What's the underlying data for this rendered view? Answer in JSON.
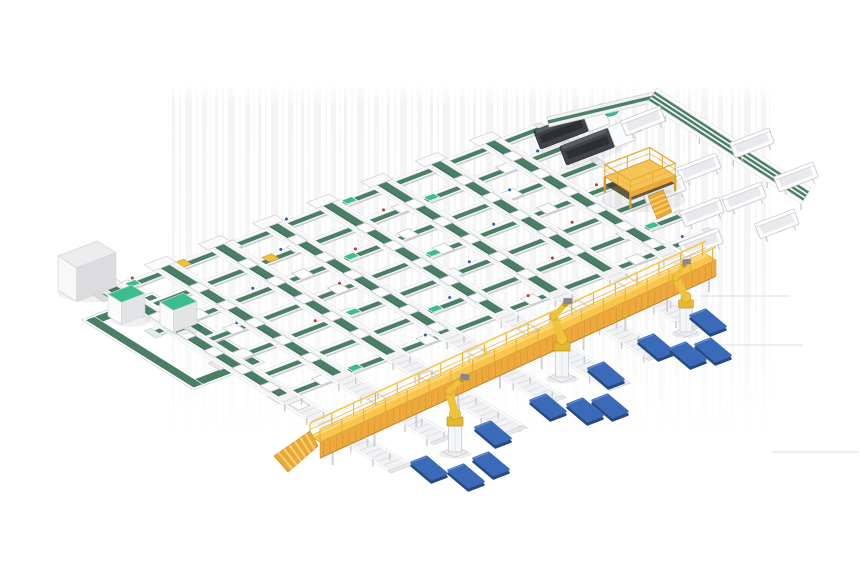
{
  "meta": {
    "description": "3D isometric render of an automated parcel sorting facility: grid of green belt conveyors, yellow elevated picking walkway with robot arms, blue pallets, chute bins, mezzanine platform and line-end machines on a white background",
    "canvas": {
      "width": 860,
      "height": 580
    }
  },
  "palette": {
    "background": "#ffffff",
    "artifact": "#dcdcdc",
    "frame": "#f1f2f4",
    "frame2": "#e8e9ec",
    "frame_stroke": "#d3d5d9",
    "frame_dark": "#c9ccd1",
    "belt": "#4a7e65",
    "belt_dark": "#3c6a54",
    "teal": "#3cbd8e",
    "teal_stroke": "#2a8f69",
    "walkway_top": "#f8c64e",
    "walkway_light": "#ffd86e",
    "walkway_side": "#eda93e",
    "walkway_shade": "#d6952f",
    "walkway_stroke": "#d9a133",
    "stair": "#e9a83c",
    "stair_step": "#ffd267",
    "stair_stroke": "#cf8f2b",
    "robot_yellow": "#eec33c",
    "robot_shade": "#c79d27",
    "robot_base": "#e5b92f",
    "gripper": "#85888c",
    "pallet_top": "#3a6ab8",
    "pallet_edge": "#274a80",
    "pallet_hi": "#6f97d2",
    "machine": "#3f4449",
    "machine_dark": "#2c3033",
    "machine_hi": "#585f64",
    "item_stroke": "#c8cbd0",
    "dot_red": "#c0392b",
    "dot_blue": "#2b5fb0",
    "leg": "#cdd0d4",
    "platform_deck": "#f5c455",
    "platform_under": "#4a3f28",
    "platform_rail": "#e8ae3c",
    "platform_stroke": "#d89c2f",
    "cabinet_top": "#ededef",
    "cabinet_left": "#f8f8f9",
    "cabinet_right": "#dcdcdf",
    "box_left": "#fbfbfc",
    "box_right": "#e3e4e6"
  },
  "scene": {
    "background": {
      "streak_band": {
        "x": 168,
        "y": 84,
        "w": 605,
        "h": 356
      },
      "faint_lines": [
        [
          700,
          296,
          790,
          296
        ],
        [
          718,
          345,
          803,
          345
        ],
        [
          772,
          452,
          858,
          452
        ]
      ]
    },
    "lattice": {
      "origin": [
        98,
        298
      ],
      "u": [
        0.934,
        -0.358
      ],
      "v": [
        0.848,
        0.53
      ],
      "rows": {
        "count": 7,
        "spacing": 33,
        "length": 480,
        "starts": [
          0,
          10,
          -4,
          14,
          4,
          18,
          8
        ]
      },
      "lanes": {
        "xs": [
          20,
          78,
          136,
          194,
          252,
          310,
          368,
          426
        ],
        "top": -18,
        "belt_end": 196,
        "ends": [
          332,
          318,
          340,
          322,
          334,
          316,
          300,
          245
        ]
      },
      "yellow_items": [
        [
          88,
          -7
        ],
        [
          152,
          26
        ]
      ],
      "loop": {
        "outer": [
          -34,
          18,
          42,
          150
        ],
        "strips": [
          [
            -32,
            20,
            40,
            30
          ],
          [
            -32,
            138,
            40,
            148
          ],
          [
            -32,
            20,
            -22,
            148
          ],
          [
            30,
            20,
            40,
            148
          ]
        ]
      }
    },
    "cabinet": {
      "x": 58,
      "y": 290,
      "du": 42,
      "dv": 22,
      "h": 34
    },
    "tote_boxes": [
      {
        "x": 108,
        "y": 316,
        "du": 25,
        "dv": 16,
        "h": 22
      },
      {
        "x": 160,
        "y": 324,
        "du": 25,
        "dv": 16,
        "h": 22
      }
    ],
    "machines": [
      [
        537,
        140
      ],
      [
        563,
        156
      ]
    ],
    "platform": {
      "cx": 640,
      "cy": 192,
      "half_u": 24,
      "half_v": 15,
      "deck_h": 16,
      "rail_h": 12,
      "stairs": [
        [
          648,
          196
        ],
        [
          663,
          190
        ],
        [
          672,
          212
        ],
        [
          657,
          219
        ]
      ]
    },
    "wing": {
      "connector": {
        "from": [
          548,
          122
        ],
        "to": [
          654,
          97
        ]
      },
      "multilane": {
        "from": [
          652,
          96
        ],
        "to": [
          806,
          196
        ],
        "half_w": 9,
        "stripe_offsets": [
          -4.2,
          0,
          4.2
        ]
      },
      "troughs": [
        [
          643,
          121
        ],
        [
          752,
          143
        ],
        [
          699,
          168
        ],
        [
          796,
          177
        ],
        [
          664,
          190
        ],
        [
          744,
          197
        ],
        [
          702,
          212
        ],
        [
          777,
          224
        ],
        [
          701,
          243
        ]
      ]
    },
    "walkway": {
      "from": [
        310,
        436
      ],
      "to": [
        706,
        254
      ],
      "depth": [
        10,
        6.2
      ],
      "fascia_h": 16,
      "stairs": [
        [
          310,
          431
        ],
        [
          318,
          446
        ],
        [
          288,
          472
        ],
        [
          274,
          456
        ]
      ]
    },
    "robots": [
      {
        "x": 455,
        "y": 452,
        "s": 1.0,
        "pose": 8
      },
      {
        "x": 562,
        "y": 377,
        "s": 1.0,
        "pose": 2
      },
      {
        "x": 686,
        "y": 332,
        "s": 0.92,
        "pose": -6
      }
    ],
    "pallet_shape": {
      "pu": [
        7.5,
        -2.9
      ],
      "pv": [
        10,
        8.4
      ],
      "thickness": 3.2
    },
    "pallets": [
      [
        708,
        321
      ],
      [
        656,
        346
      ],
      [
        688,
        354
      ],
      [
        713,
        350
      ],
      [
        606,
        374
      ],
      [
        548,
        406
      ],
      [
        585,
        410
      ],
      [
        610,
        406
      ],
      [
        493,
        433
      ],
      [
        429,
        468
      ],
      [
        466,
        476
      ],
      [
        491,
        464
      ]
    ],
    "counts": {
      "sorter_lines": 7,
      "cross_belt_lanes": 8,
      "robot_arms": 3,
      "pallets": 12,
      "chute_bins": 9,
      "line_end_machines": 2,
      "tote_boxes": 2
    }
  }
}
